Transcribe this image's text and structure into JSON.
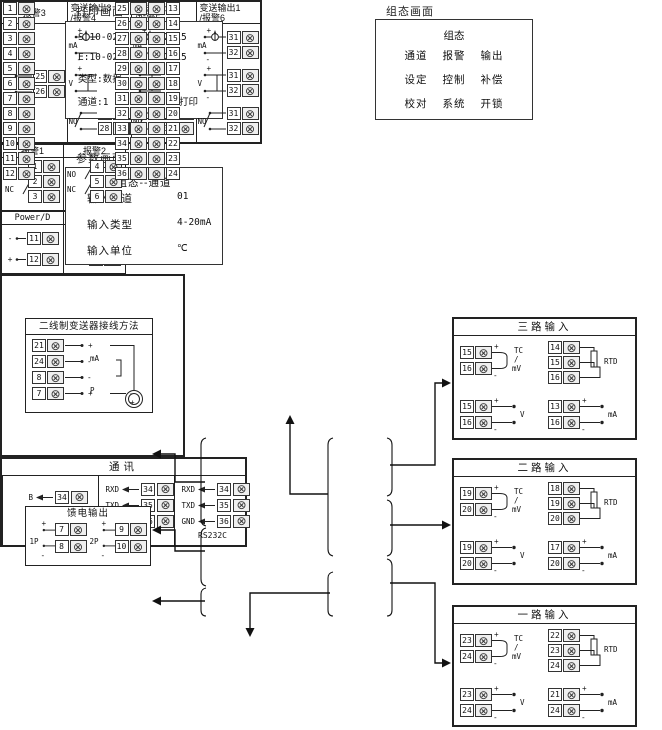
{
  "icons": {
    "screw_terminal": "⊗"
  },
  "colors": {
    "line": "#222222",
    "background": "#ffffff",
    "screw_fill": "#efefef"
  },
  "print_screen": {
    "title": "打印画面",
    "lines": [
      "S:10-02-27 11:12:15",
      "E:10-02-28 11:12:15",
      "类型:数据"
    ],
    "channel": "通道:1",
    "print_btn": "打印"
  },
  "config_screen": {
    "title": "组态画面",
    "heading": "组态",
    "rows": [
      [
        "通道",
        "报警",
        "输出"
      ],
      [
        "设定",
        "控制",
        "补偿"
      ],
      [
        "校对",
        "系统",
        "开锁"
      ]
    ]
  },
  "param_screen": {
    "title": "参数画面",
    "heading": "组态--通道",
    "rows": [
      {
        "label": "输入通道",
        "value": "01"
      },
      {
        "label": "输入类型",
        "value": "4-20mA"
      },
      {
        "label": "输入单位",
        "value": "℃"
      }
    ]
  },
  "output_panel": {
    "alarm": {
      "title": "报警3",
      "t_top": "25",
      "t_bot": "26"
    },
    "columns": [
      {
        "title1": "变送输出3",
        "title2": "/报警4",
        "t_top": "27",
        "t_bot": "28"
      },
      {
        "title1": "变送输出2",
        "title2": "/报警5",
        "t_top": "29",
        "t_bot": "30"
      },
      {
        "title1": "变送输出1",
        "title2": "/报警6",
        "t_top": "31",
        "t_bot": "32"
      }
    ],
    "labels": {
      "ma": "mA",
      "v": "V",
      "no": "NO",
      "plus": "+",
      "minus": "-"
    }
  },
  "two_wire": {
    "title": "二线制变送器接线方法",
    "rows": [
      {
        "term": "21",
        "sign": "+"
      },
      {
        "term": "24",
        "sign": "-"
      },
      {
        "term": "8",
        "sign": "-"
      },
      {
        "term": "7",
        "sign": "+"
      }
    ],
    "ma_label": "mA",
    "p_label": "P",
    "transmitter_minus": "-",
    "transmitter_plus": "+"
  },
  "alarm12": {
    "cols": [
      {
        "title": "报警1",
        "no": "NO",
        "nc": "NC",
        "terms": [
          "1",
          "2",
          "3"
        ]
      },
      {
        "title": "报警2",
        "no": "NO",
        "nc": "NC",
        "terms": [
          "4",
          "5",
          "6"
        ]
      }
    ]
  },
  "feed": {
    "title": "馈电输出",
    "groups": [
      {
        "label": "1P",
        "plus": "+",
        "minus": "-",
        "t_top": "7",
        "t_bot": "8"
      },
      {
        "label": "2P",
        "plus": "+",
        "minus": "-",
        "t_top": "9",
        "t_bot": "10"
      }
    ]
  },
  "power": {
    "cols": [
      {
        "title": "Power/D",
        "rows": [
          {
            "sign": "-",
            "term": "11"
          },
          {
            "sign": "+",
            "term": "12"
          }
        ]
      },
      {
        "title": "Power/A",
        "rows": [
          {
            "sign": "L",
            "term": "11"
          },
          {
            "sign": "N",
            "term": "12"
          }
        ]
      }
    ]
  },
  "central": {
    "left": [
      "1",
      "2",
      "3",
      "4",
      "5",
      "6",
      "7",
      "8",
      "9",
      "10",
      "11",
      "12"
    ],
    "right": [
      {
        "l": "25",
        "r": "13"
      },
      {
        "l": "26",
        "r": "14"
      },
      {
        "l": "27",
        "r": "15"
      },
      {
        "l": "28",
        "r": "16"
      },
      {
        "l": "29",
        "r": "17"
      },
      {
        "l": "30",
        "r": "18"
      },
      {
        "l": "31",
        "r": "19"
      },
      {
        "l": "32",
        "r": "20"
      },
      {
        "l": "33",
        "r": "21"
      },
      {
        "l": "34",
        "r": "22"
      },
      {
        "l": "35",
        "r": "23"
      },
      {
        "l": "36",
        "r": "24"
      }
    ]
  },
  "comm": {
    "title": "通讯",
    "sections": [
      {
        "label": "RS485",
        "rows": [
          {
            "sig": "B",
            "term": "34"
          },
          {
            "sig": "A",
            "term": "35"
          }
        ]
      },
      {
        "label": "RS232",
        "rows": [
          {
            "sig": "RXD",
            "term": "34"
          },
          {
            "sig": "TXD",
            "term": "35"
          },
          {
            "sig": "GND",
            "term": "36"
          }
        ]
      },
      {
        "label": "RS232C",
        "rows": [
          {
            "sig": "RXD",
            "term": "34"
          },
          {
            "sig": "TXD",
            "term": "35"
          },
          {
            "sig": "GND",
            "term": "36"
          }
        ]
      }
    ]
  },
  "inputs": {
    "labels": {
      "tc": "TC",
      "slash": "/",
      "mv": "mV",
      "rtd": "RTD",
      "v": "V",
      "ma": "mA",
      "plus": "+",
      "minus": "-"
    },
    "boxes": [
      {
        "title": "三路输入",
        "tc_top": "15",
        "tc_bot": "16",
        "rtd1": "14",
        "rtd2": "15",
        "rtd3": "16",
        "v_top": "15",
        "v_bot": "16",
        "ma_top": "13",
        "ma_bot": "16"
      },
      {
        "title": "二路输入",
        "tc_top": "19",
        "tc_bot": "20",
        "rtd1": "18",
        "rtd2": "19",
        "rtd3": "20",
        "v_top": "19",
        "v_bot": "20",
        "ma_top": "17",
        "ma_bot": "20"
      },
      {
        "title": "一路输入",
        "tc_top": "23",
        "tc_bot": "24",
        "rtd1": "22",
        "rtd2": "23",
        "rtd3": "24",
        "v_top": "23",
        "v_bot": "24",
        "ma_top": "21",
        "ma_bot": "24"
      }
    ]
  }
}
